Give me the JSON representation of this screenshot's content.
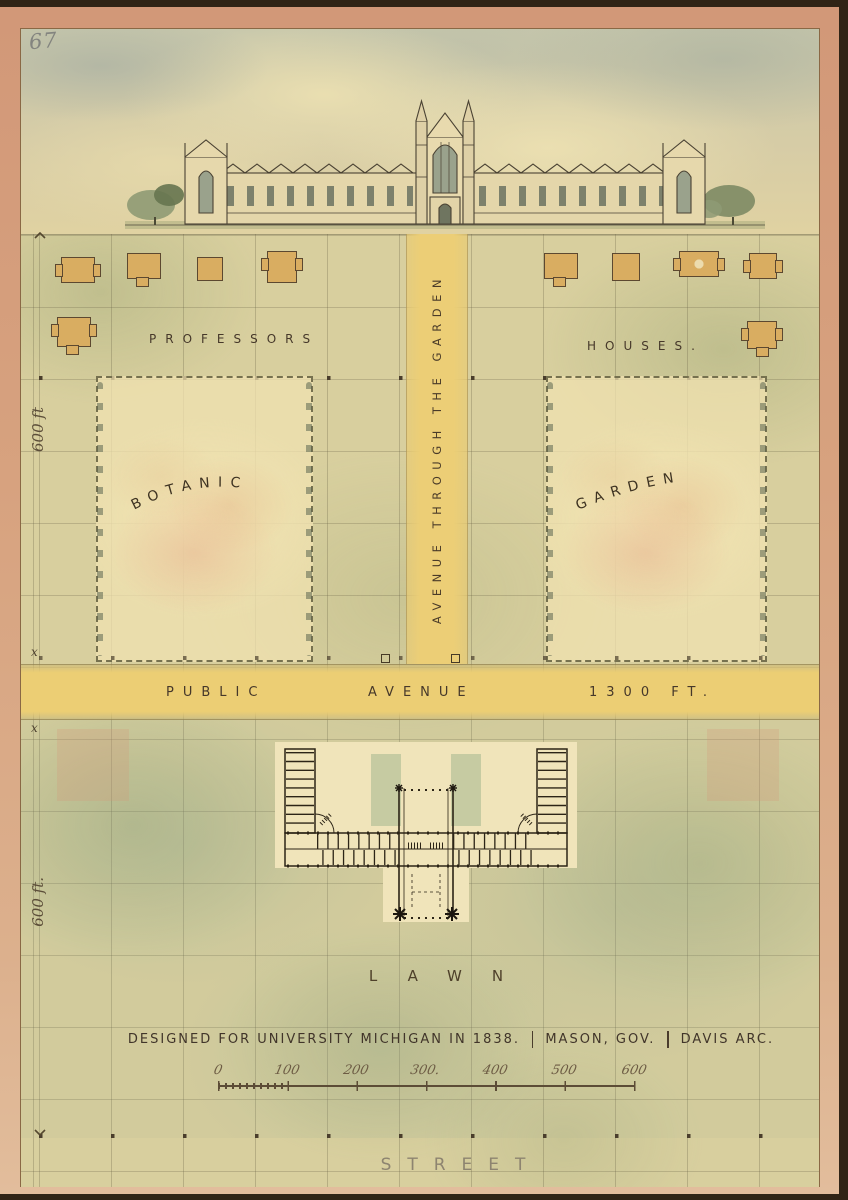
{
  "page_number": "67",
  "labels": {
    "professors": "PROFESSORS",
    "houses": "HOUSES.",
    "avenue_through_garden": "AVENUE THROUGH THE GARDEN",
    "botanic": "BOTANIC",
    "garden": "GARDEN",
    "public": "PUBLIC",
    "avenue": "AVENUE",
    "avenue_length": "1300 FT.",
    "lawn": "LAWN",
    "street": "STREET"
  },
  "dimensions": {
    "left_top": "600 ft",
    "avenue_mark_top": "x",
    "avenue_width": "100",
    "avenue_mark_bottom": "x",
    "left_bottom": "600 ft."
  },
  "caption": {
    "design": "DESIGNED FOR UNIVERSITY MICHIGAN IN 1838.",
    "governor": "MASON, GOV.",
    "architect": "DAVIS ARC."
  },
  "scalebar": {
    "ticks": [
      "0",
      "100",
      "200",
      "300.",
      "400",
      "500",
      "600"
    ]
  },
  "colors": {
    "frame_mat": "#d7a27f",
    "paper": "#e2d3a0",
    "avenue_yellow": "#ecce76",
    "ink": "#46382a",
    "pencil": "#8d8472",
    "wash_green": "#b9c49a",
    "garden_pink": "#e2a082"
  }
}
